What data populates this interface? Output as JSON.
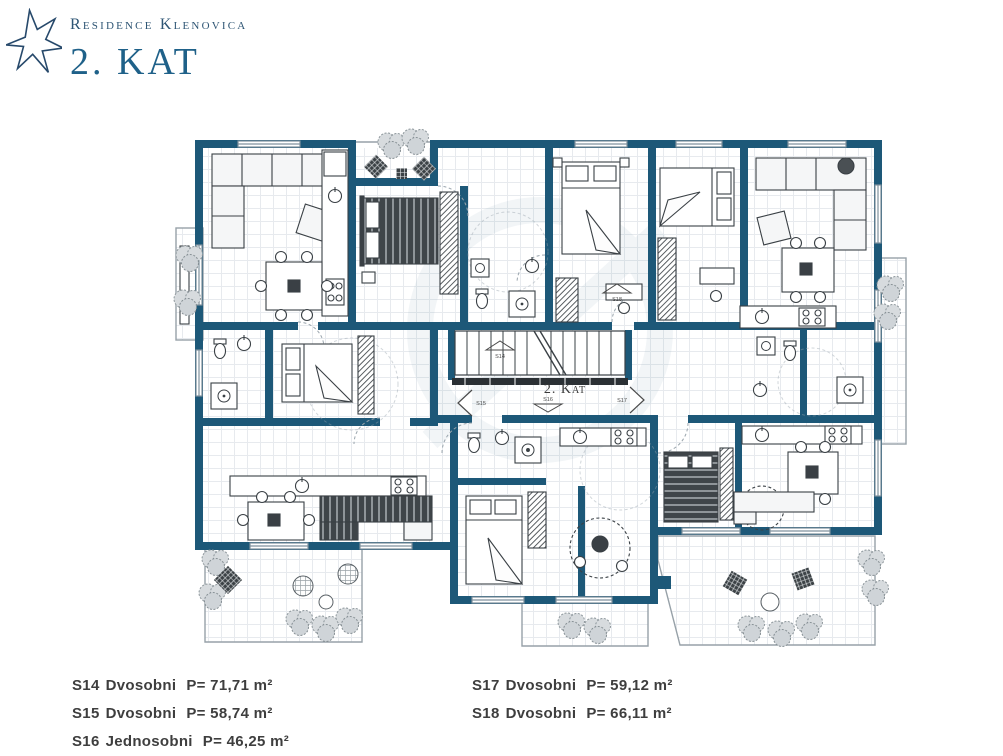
{
  "header": {
    "logo_icon": "six-pointed-star-icon",
    "brand": "Residence Klenovica",
    "floor_title": "2. KAT"
  },
  "plan": {
    "center_label": "2. Kat",
    "markers": [
      "S14",
      "S15",
      "S16",
      "S17",
      "S18"
    ],
    "colors": {
      "wall": "#1d5878",
      "furniture_line": "#3a4045",
      "greenery": "#8e979c",
      "tile_line": "#e7eaee",
      "title_blue": "#1f6189"
    }
  },
  "legend": {
    "left": [
      {
        "unit": "S14",
        "type": "Dvosobni",
        "area": "P= 71,71 m²"
      },
      {
        "unit": "S15",
        "type": "Dvosobni",
        "area": "P= 58,74 m²"
      },
      {
        "unit": "S16",
        "type": "Jednosobni",
        "area": "P= 46,25 m²"
      }
    ],
    "right": [
      {
        "unit": "S17",
        "type": "Dvosobni",
        "area": "P= 59,12 m²"
      },
      {
        "unit": "S18",
        "type": "Dvosobni",
        "area": "P= 66,11 m²"
      }
    ]
  }
}
